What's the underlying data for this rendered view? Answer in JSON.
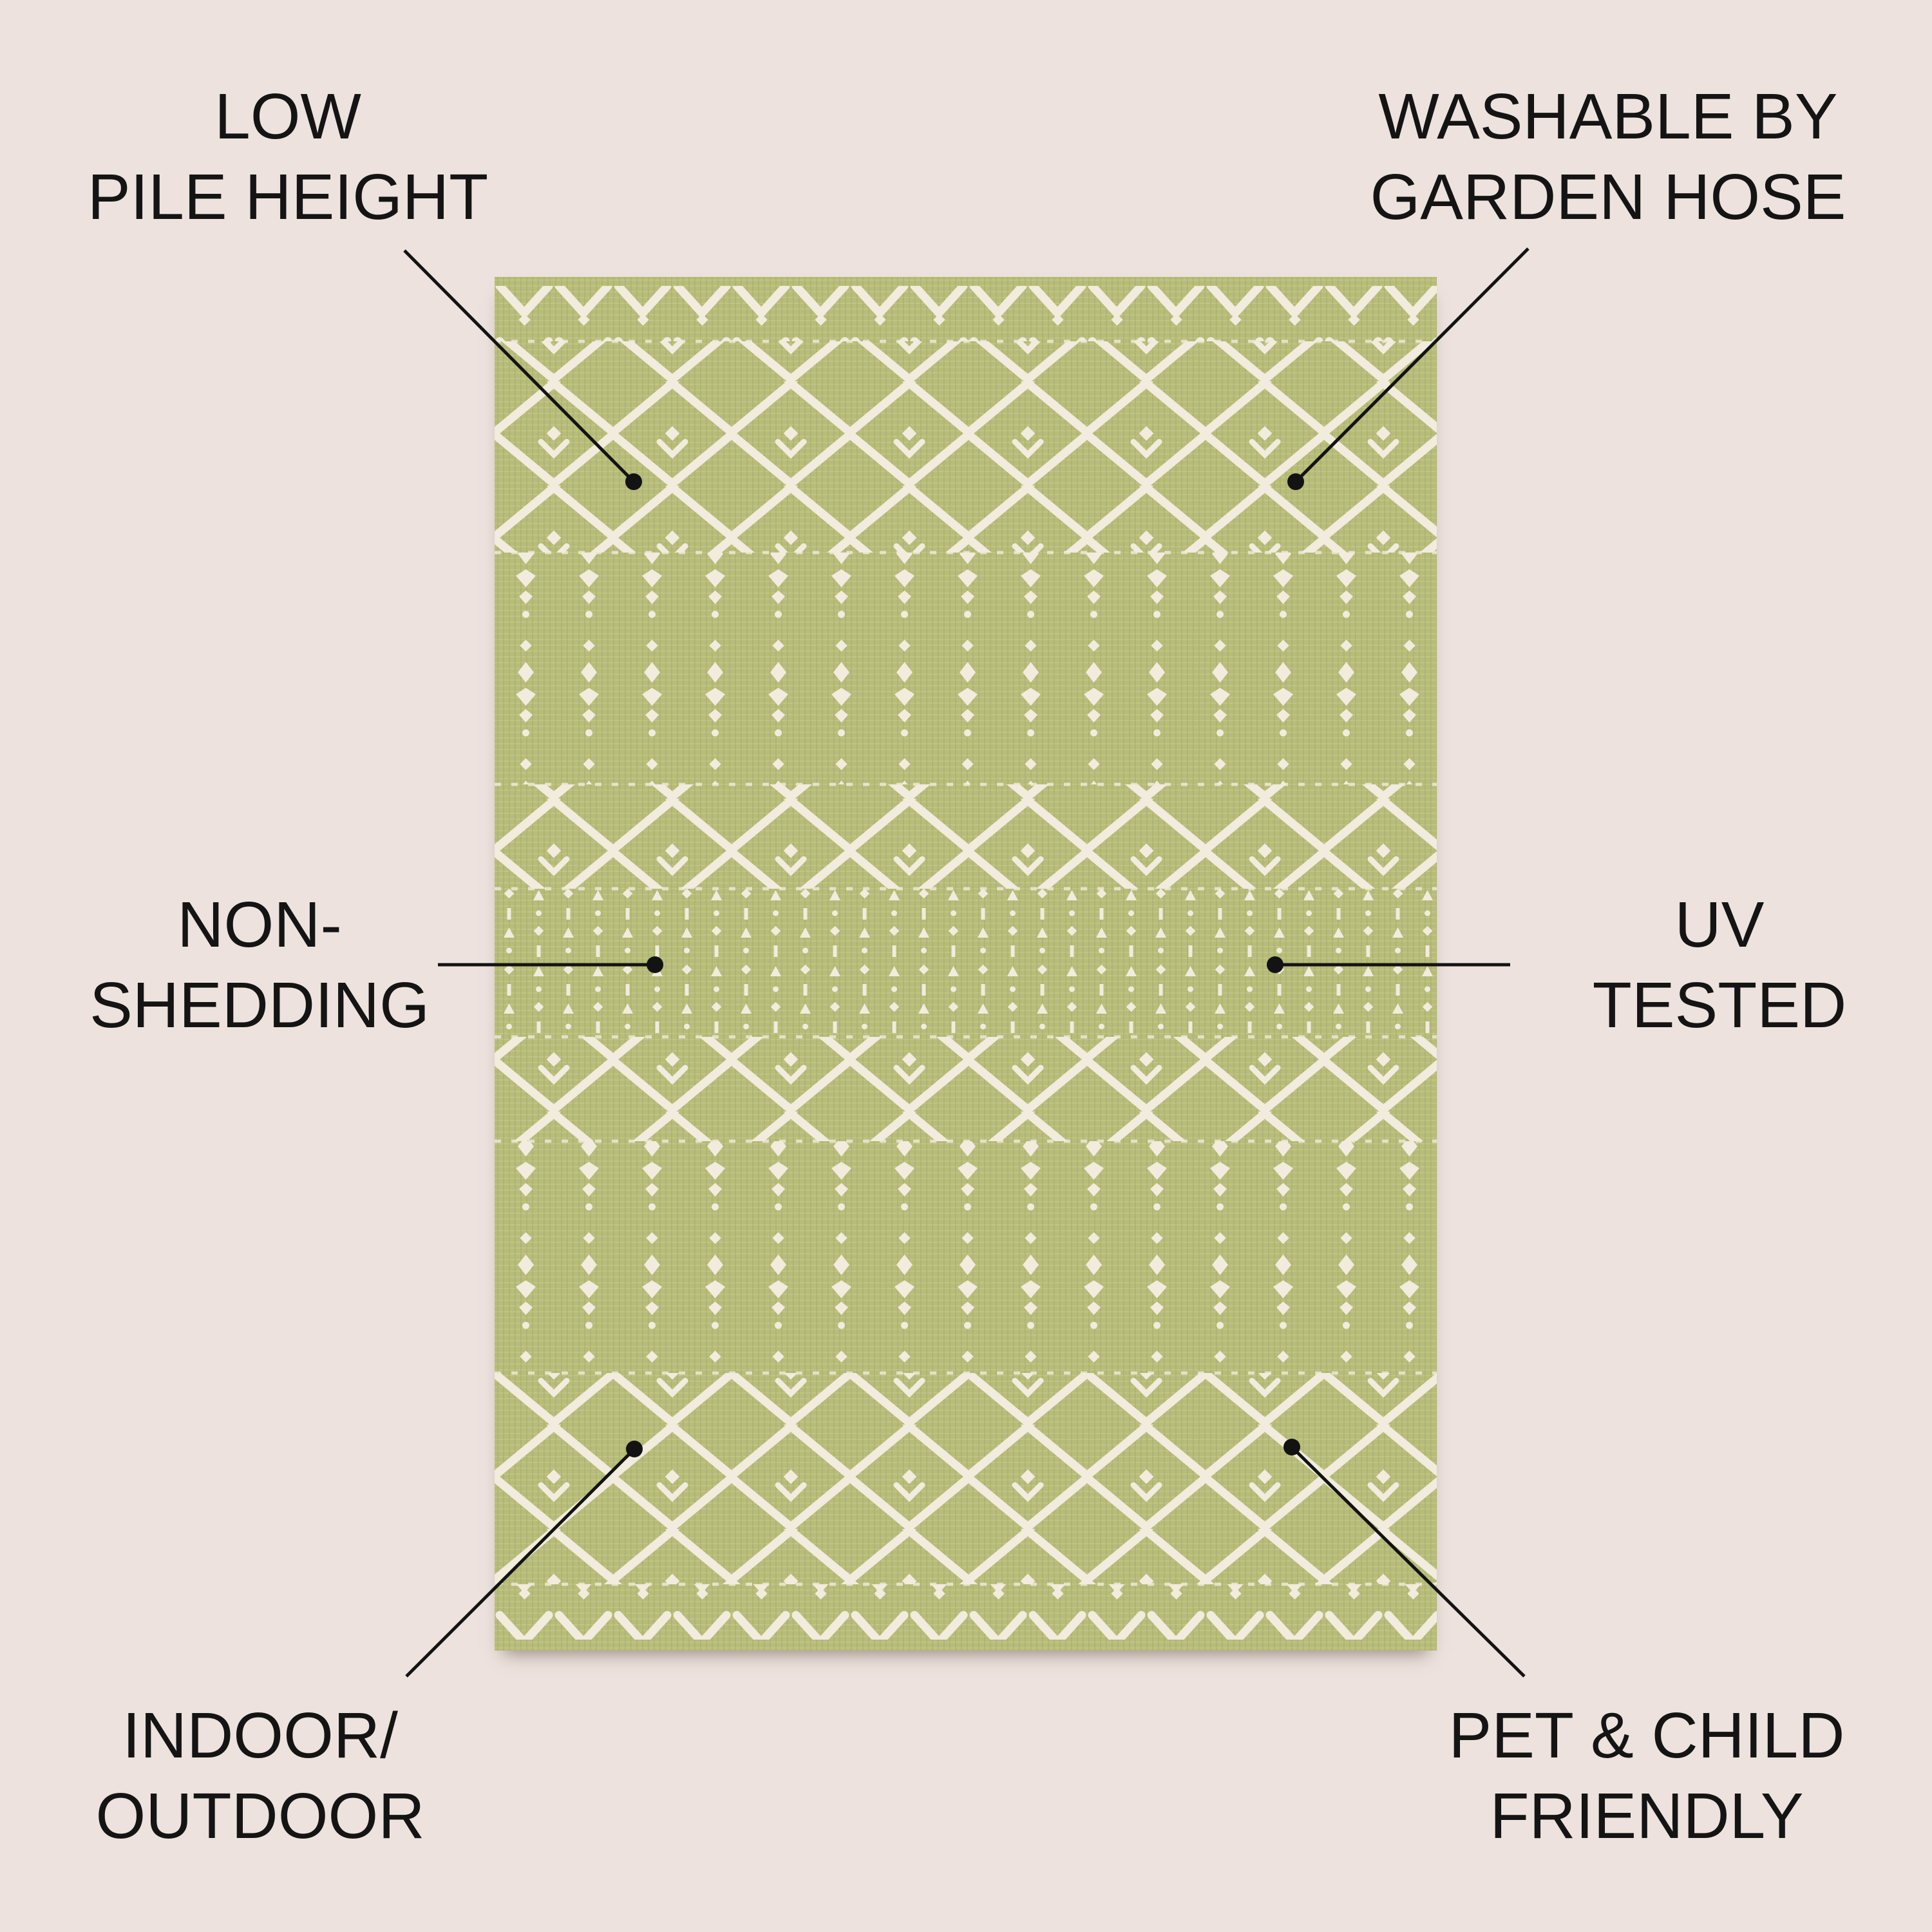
{
  "colors": {
    "background": "#EDE2DD",
    "text": "#141414",
    "connector": "#131313",
    "rug-green": "#B7BC7A",
    "rug-green-light": "#C9CD90",
    "rug-green-dark": "#9DA45F",
    "rug-cream": "#F1ECDD"
  },
  "rug": {
    "description": "green and cream moroccan diamond trellis flatweave rug, portrait orientation"
  },
  "callouts": [
    {
      "id": "low-pile-height",
      "position": "top-left",
      "lines": [
        "LOW",
        "PILE HEIGHT"
      ]
    },
    {
      "id": "washable-by-garden-hose",
      "position": "top-right",
      "lines": [
        "WASHABLE BY",
        "GARDEN HOSE"
      ]
    },
    {
      "id": "non-shedding",
      "position": "middle-left",
      "lines": [
        "NON-",
        "SHEDDING"
      ]
    },
    {
      "id": "uv-tested",
      "position": "middle-right",
      "lines": [
        "UV",
        "TESTED"
      ]
    },
    {
      "id": "indoor-outdoor",
      "position": "bottom-left",
      "lines": [
        "INDOOR/",
        "OUTDOOR"
      ]
    },
    {
      "id": "pet-child-friendly",
      "position": "bottom-right",
      "lines": [
        "PET & CHILD",
        "FRIENDLY"
      ]
    }
  ]
}
